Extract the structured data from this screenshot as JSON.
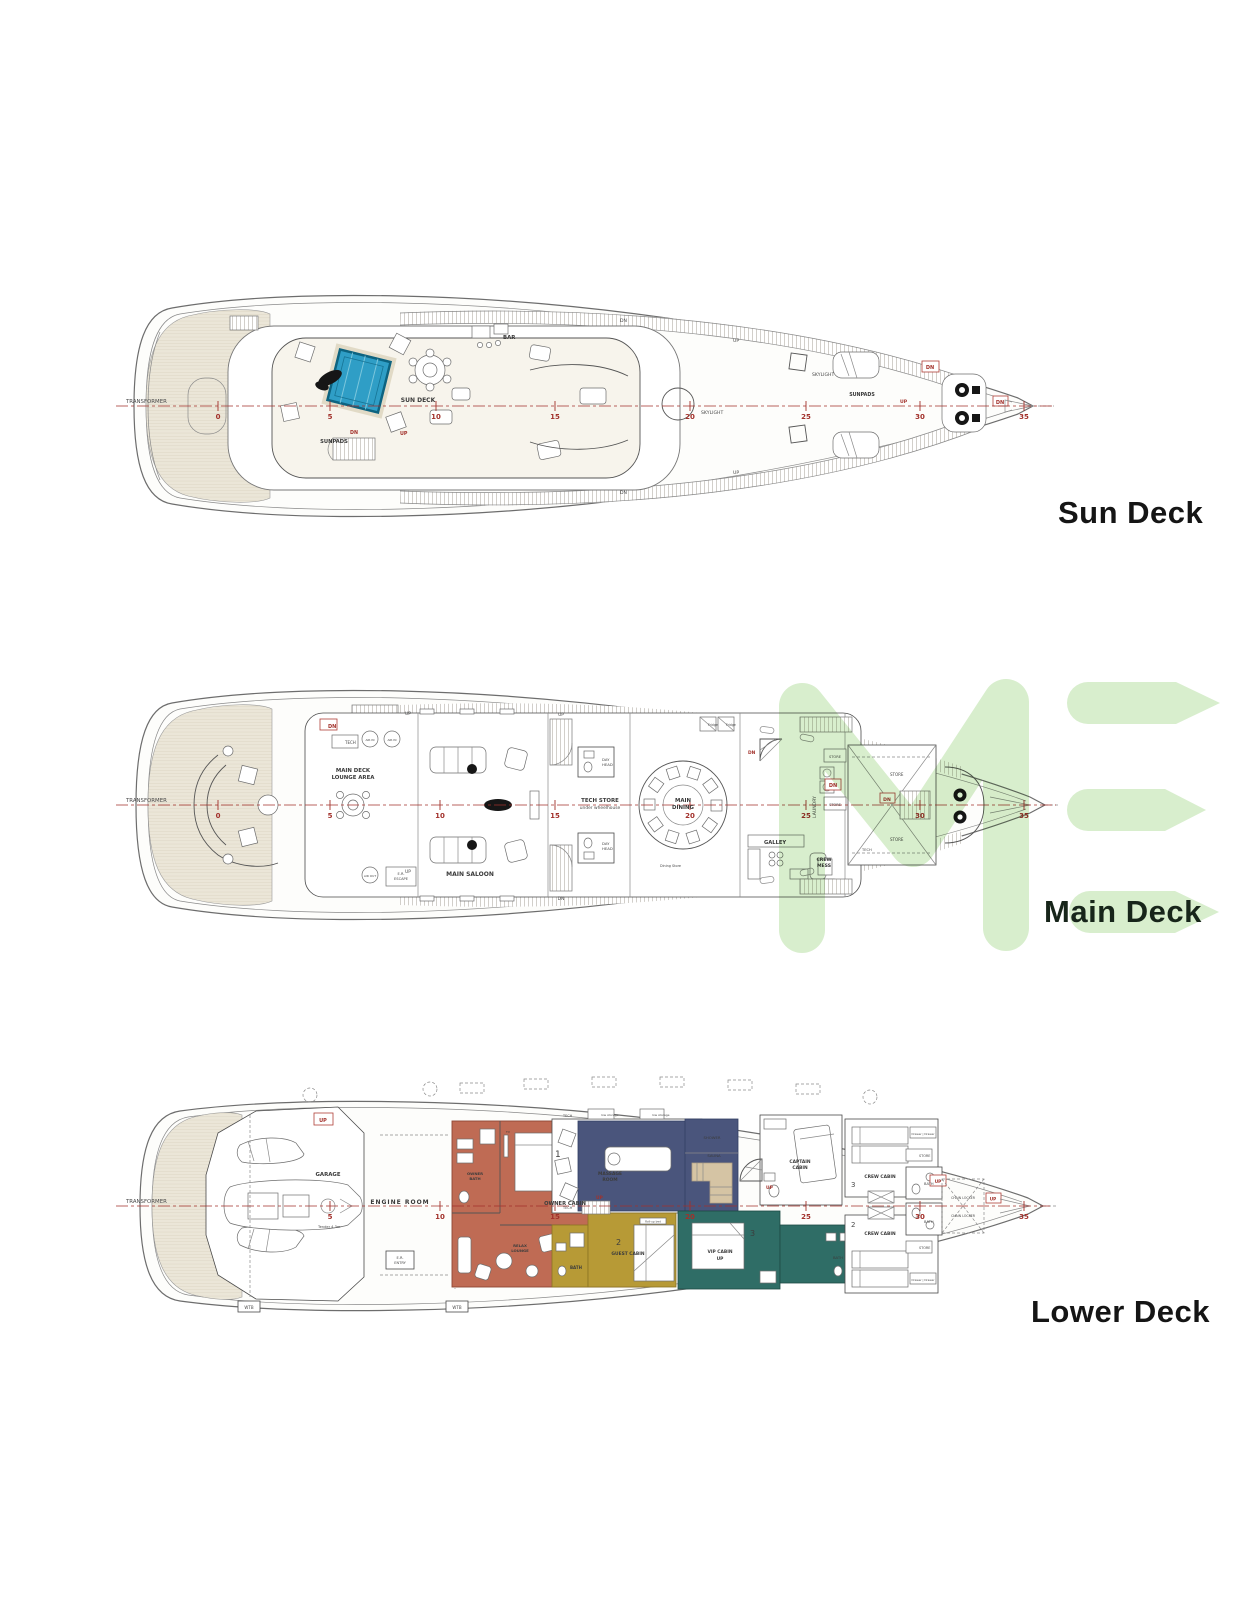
{
  "page": {
    "background": "#ffffff"
  },
  "watermark": {
    "letters": "ME",
    "color": "#d8eecd"
  },
  "colors": {
    "centerline": "#a2312b",
    "station_number": "#a2312b",
    "pool": "#2f9ec6",
    "owner_cabin": "#bf6b54",
    "guest_cabin": "#b79a36",
    "vip_cabin": "#2f6d66",
    "massage_room": "#4a557c",
    "sauna_bench": "#d5c4a4",
    "teak": "#ebe6d8",
    "plan_line": "#6d6d6d",
    "deck_label": "#151515",
    "marker_red": "#a2312b",
    "watermark_green": "#d8eecd"
  },
  "deck_labels": {
    "sun": "Sun Deck",
    "main": "Main Deck",
    "lower": "Lower Deck"
  },
  "stations": [
    "0",
    "5",
    "10",
    "15",
    "20",
    "25",
    "30",
    "35"
  ],
  "markers": {
    "dn": "DN",
    "up": "UP",
    "wtb": "WTB",
    "tech": "TECH",
    "store": "STORE",
    "bath": "BATH",
    "tv": "TV",
    "fridge": "Fridge",
    "low_storage": "low storage",
    "transformer": "TRANSFORMER"
  },
  "sun_deck": {
    "name": "SUN DECK",
    "sunpads_aft": "SUNPADS",
    "bar": "BAR",
    "skylight_mid": "SKYLIGHT",
    "skylight_fwd": "SKYLIGHT",
    "sunpads_fwd": "SUNPADS"
  },
  "main_deck": {
    "lounge_line1": "MAIN DECK",
    "lounge_line2": "LOUNGE AREA",
    "saloon": "MAIN SALOON",
    "tech_store_line1": "TECH STORE",
    "tech_store_line2": "under wheelhouse",
    "day_head_line1": "DAY",
    "day_head_line2": "HEAD",
    "dining_line1": "MAIN",
    "dining_line2": "DINING",
    "galley": "GALLEY",
    "crew_mess_line1": "CREW",
    "crew_mess_line2": "MESS",
    "laundry": "LAUNDRY",
    "air_in": "AIR IN",
    "air_out": "AIR OUT",
    "er_escape_line1": "E.R.",
    "er_escape_line2": "ESCAPE",
    "dining_store": "Dining Store"
  },
  "lower_deck": {
    "garage": "GARAGE",
    "tender": "Tender 4,3m",
    "engine_room": "ENGINE ROOM",
    "er_entry_line1": "E.R.",
    "er_entry_line2": "ENTRY",
    "owner_bath_line1": "OWNER",
    "owner_bath_line2": "BATH",
    "owner_cabin": "OWNER CABIN",
    "owner_no": "1",
    "relax_line1": "RELAX",
    "relax_line2": "LOUNGE",
    "massage_line1": "MASSAGE",
    "massage_line2": "ROOM",
    "shower": "SHOWER",
    "sauna": "SAUNA",
    "captain_line1": "CAPTAIN",
    "captain_line2": "CABIN",
    "guest_cabin": "GUEST CABIN",
    "guest_no": "2",
    "roll_up_bed": "Roll-up bed",
    "vip_line1": "VIP CABIN",
    "vip_line2": "UP",
    "vip_no": "3",
    "crew_cabin": "CREW CABIN",
    "crew_no_top": "3",
    "crew_no_bottom": "2",
    "chain_locker": "CHAIN LOCKER",
    "drawer": "Drawer | Drawer"
  }
}
